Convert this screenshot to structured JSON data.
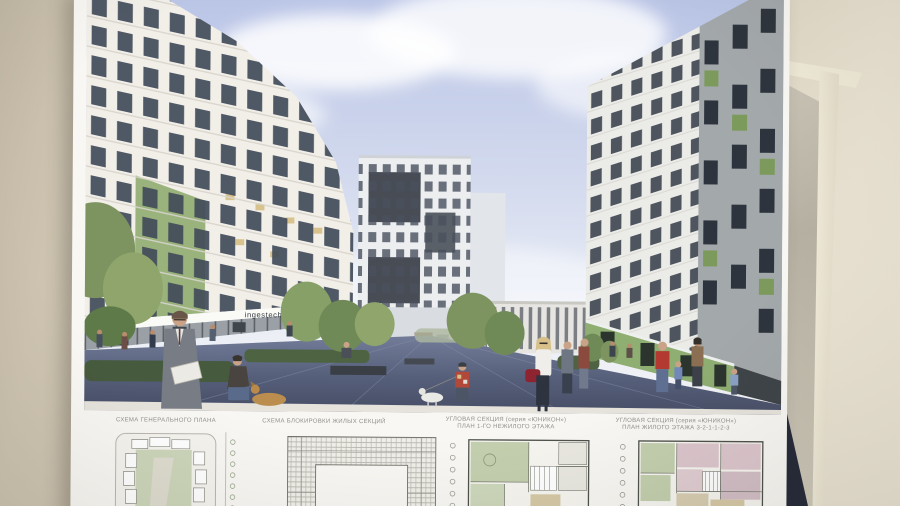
{
  "photo": {
    "wall": {
      "left_color": "#cdc3b0",
      "right_color": "#ece6d6"
    },
    "poster": {
      "background": "#f8f7f3"
    }
  },
  "board": {
    "rendering": {
      "storefront_sign": "ingestech",
      "palette": {
        "sky": "#b9c4e6",
        "facade_white": "#f2efe9",
        "facade_gray": "#ebebe8",
        "accent_green": "#9ab37c",
        "storefront_green": "#8fae72",
        "plaza": "#545d78"
      }
    },
    "plans": [
      {
        "caption": "СХЕМА ГЕНЕРАЛЬНОГО ПЛАНА",
        "caption2": ""
      },
      {
        "caption": "СХЕМА БЛОКИРОВКИ ЖИЛЫХ СЕКЦИЙ",
        "caption2": ""
      },
      {
        "caption": "УГЛОВАЯ СЕКЦИЯ (серия «ЮНИКОН»)",
        "caption2": "ПЛАН 1-ГО НЕЖИЛОГО ЭТАЖА"
      },
      {
        "caption": "УГЛОВАЯ СЕКЦИЯ (серия «ЮНИКОН»)",
        "caption2": "ПЛАН ЖИЛОГО ЭТАЖА 3-2-1-1-2-3"
      }
    ]
  }
}
